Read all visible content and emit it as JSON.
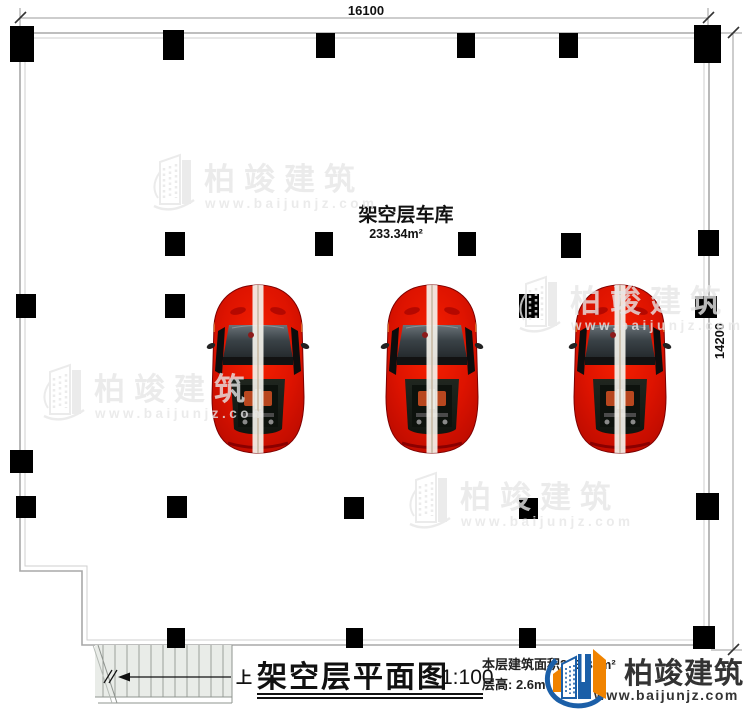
{
  "plan": {
    "top_dimension": "16100",
    "right_dimension": "14200",
    "room_label": "架空层车库",
    "room_area": "233.34m²",
    "stair_direction_label": "上"
  },
  "watermark": {
    "brand": "柏竣建筑",
    "url": "www.baijunjz.com"
  },
  "footer": {
    "title": "架空层平面图",
    "scale": "1:100",
    "area_line": "本层建筑面积233.34m²",
    "height_line": "层高: 2.6m",
    "brand": "柏竣建筑",
    "brand_url": "www.baijunjz.com"
  },
  "colors": {
    "column": "#000000",
    "wall": "#a8a8a8",
    "car_red": "#d81600",
    "logo_blue": "#1b5fa8",
    "logo_orange": "#f08300",
    "watermark_gray": "#e7e7e7"
  }
}
